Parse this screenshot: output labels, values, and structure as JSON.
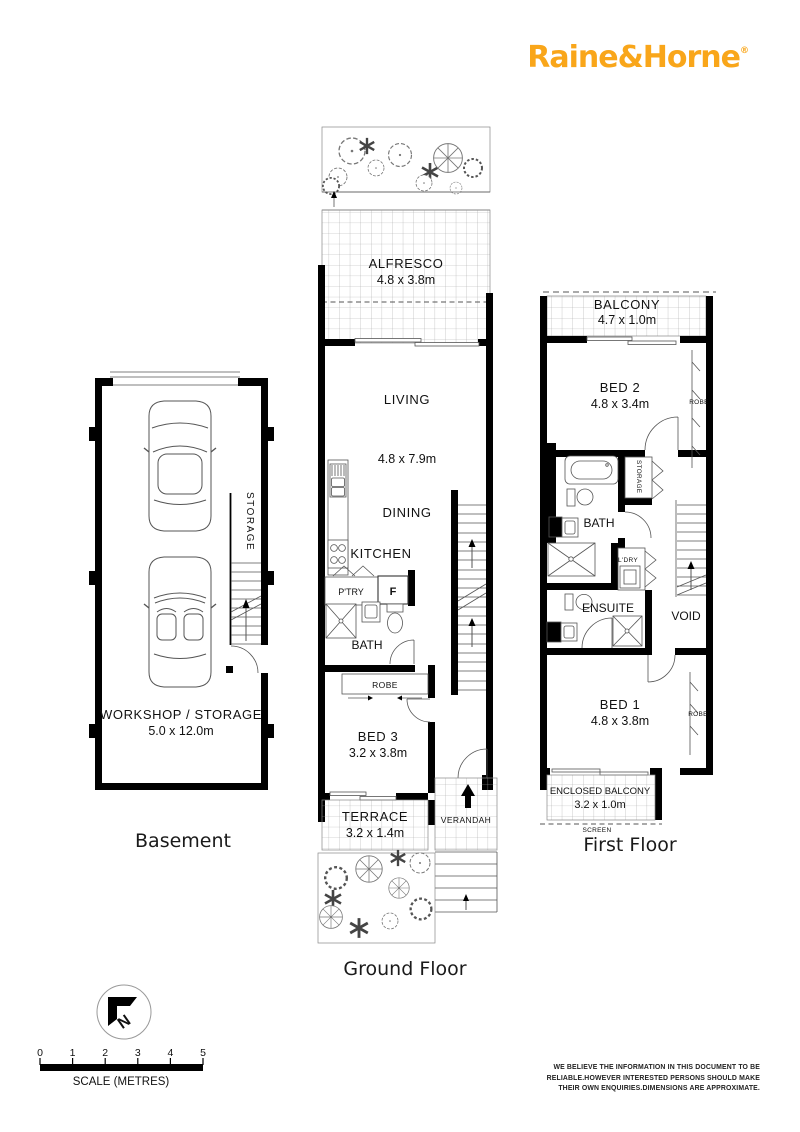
{
  "logo": {
    "brand": "Raine&Horne",
    "registered": "®"
  },
  "colors": {
    "brand_gold": "#F9A61A"
  },
  "basement": {
    "title": "Basement",
    "workshop": "WORKSHOP / STORAGE",
    "workshop_dims": "5.0 x 12.0m",
    "storage": "STORAGE"
  },
  "ground": {
    "title": "Ground Floor",
    "alfresco": "ALFRESCO",
    "alfresco_dims": "4.8 x 3.8m",
    "living": "LIVING",
    "living_dims": "4.8 x 7.9m",
    "dining": "DINING",
    "kitchen": "KITCHEN",
    "pantry": "P'TRY",
    "fridge": "F",
    "bath": "BATH",
    "robe": "ROBE",
    "bed3": "BED 3",
    "bed3_dims": "3.2 x 3.8m",
    "terrace": "TERRACE",
    "terrace_dims": "3.2 x 1.4m",
    "verandah": "VERANDAH"
  },
  "first": {
    "title": "First Floor",
    "balcony": "BALCONY",
    "balcony_dims": "4.7 x 1.0m",
    "bed2": "BED 2",
    "bed2_dims": "4.8 x 3.4m",
    "robe_bed2": "ROBE",
    "bath": "BATH",
    "storage": "STORAGE",
    "laundry": "L'DRY",
    "ensuite": "ENSUITE",
    "void": "VOID",
    "bed1": "BED 1",
    "bed1_dims": "4.8 x 3.8m",
    "robe_bed1": "ROBE",
    "enclosed_balcony": "ENCLOSED BALCONY",
    "enclosed_balcony_dims": "3.2 x 1.0m",
    "screen": "SCREEN"
  },
  "compass": {
    "letter": "N"
  },
  "scale": {
    "ticks": [
      "0",
      "1",
      "2",
      "3",
      "4",
      "5"
    ],
    "label": "SCALE (METRES)"
  },
  "disclaimer": {
    "line1": "WE BELIEVE THE INFORMATION IN THIS DOCUMENT TO BE",
    "line2": "RELIABLE.HOWEVER INTERESTED PERSONS SHOULD MAKE",
    "line3": "THEIR OWN ENQUIRIES.DIMENSIONS ARE APPROXIMATE."
  }
}
